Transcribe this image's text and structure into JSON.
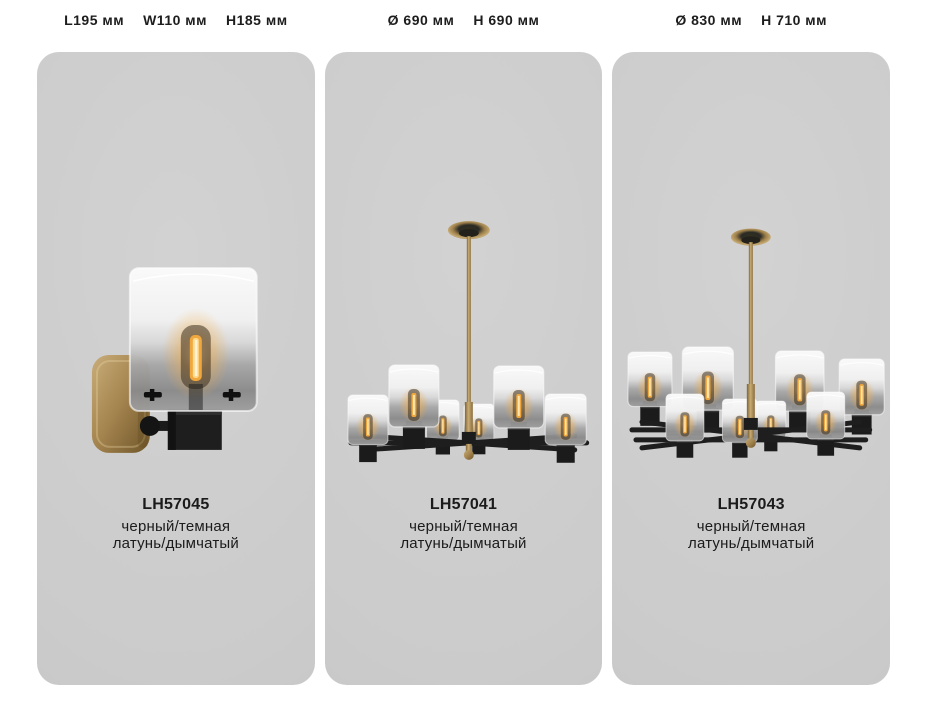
{
  "page": {
    "background": "#ffffff",
    "panel_background": "#cbcbcb",
    "text_color": "#1b1b1b"
  },
  "colors": {
    "brass": "#a8874f",
    "brass_light": "#cdb079",
    "brass_dark": "#7a5f33",
    "black_metal": "#1c1c1c",
    "glass_top": "#fafafa",
    "glass_smoke": "#8f8f8f",
    "bulb_glow": "#ffc466"
  },
  "products": [
    {
      "dimensions": [
        "L195 мм",
        "W110 мм",
        "H185 мм"
      ],
      "code": "LH57045",
      "finish_line1": "черный/темная",
      "finish_line2": "латунь/дымчатый",
      "image": "wall-sconce-one-light"
    },
    {
      "dimensions": [
        "Ø 690 мм",
        "H 690 мм"
      ],
      "code": "LH57041",
      "finish_line1": "черный/темная",
      "finish_line2": "латунь/дымчатый",
      "image": "chandelier-six-light"
    },
    {
      "dimensions": [
        "Ø 830 мм",
        "H 710 мм"
      ],
      "code": "LH57043",
      "finish_line1": "черный/темная",
      "finish_line2": "латунь/дымчатый",
      "image": "chandelier-eight-light"
    }
  ]
}
